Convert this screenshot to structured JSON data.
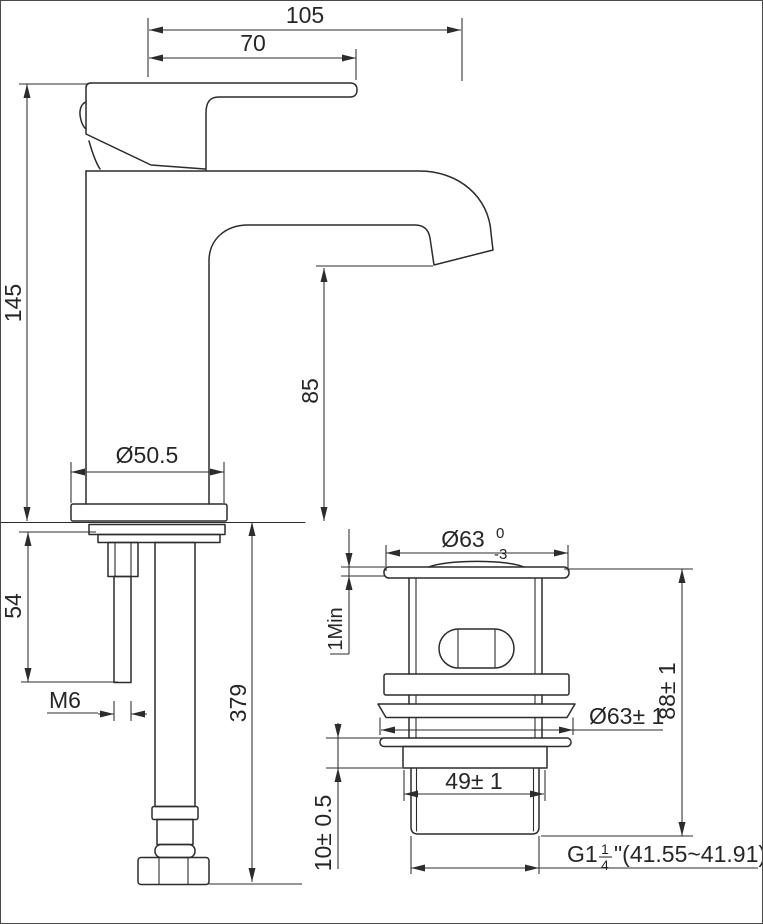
{
  "drawing": {
    "colors": {
      "line": "#2c2c2c",
      "background": "#ffffff"
    },
    "faucet_view": {
      "dims": {
        "overall_reach": "105",
        "handle_reach": "70",
        "body_height": "145",
        "spout_height": "85",
        "base_diameter": "Ø50.5",
        "stud_length": "54",
        "stud_thread": "M6",
        "hose_length": "379"
      }
    },
    "drain_view": {
      "dims": {
        "cap_diameter": "Ø63",
        "cap_tol_upper": "0",
        "cap_tol_lower": "-3",
        "cap_edge_min": "1Min",
        "flange_diameter": "Ø63± 1",
        "overall_height": "88± 1",
        "body_width": "49± 1",
        "neck_height": "10± 0.5",
        "thread_prefix": "G1",
        "thread_frac_num": "1",
        "thread_frac_den": "4",
        "thread_suffix": "\"(41.55~41.91)"
      }
    }
  }
}
